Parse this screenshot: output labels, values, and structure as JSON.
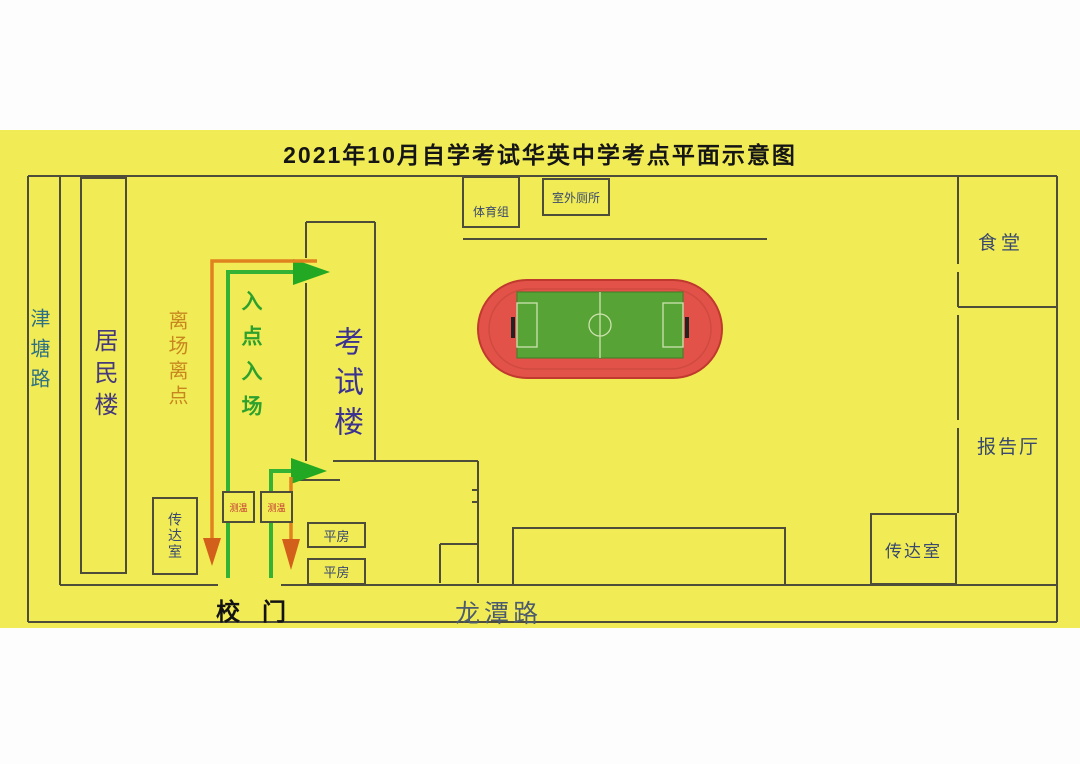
{
  "title": "2021年10月自学考试华英中学考点平面示意图",
  "roads": {
    "west": "津塘路",
    "south": "龙潭路"
  },
  "gate": {
    "label": "校门"
  },
  "buildings": {
    "residential": {
      "label": "居民楼"
    },
    "exam_building": {
      "label": "考试楼"
    },
    "sports_group": {
      "label": "体育组"
    },
    "outdoor_toilet": {
      "label": "室外厕所"
    },
    "canteen": {
      "label": "食堂"
    },
    "lecture_hall": {
      "label": "报告厅"
    },
    "gatehouse_left": {
      "label": "传达室"
    },
    "gatehouse_right": {
      "label": "传达室"
    },
    "bungalow_north": {
      "label": "平房"
    },
    "bungalow_south": {
      "label": "平房"
    },
    "temp_check_left": {
      "label": "测温"
    },
    "temp_check_right": {
      "label": "测温"
    }
  },
  "routes": {
    "entry": {
      "label": "入点入场",
      "color": "#2da02d"
    },
    "exit": {
      "label": "离场离点",
      "color": "#c8861e"
    }
  },
  "field": {
    "name": "running-track-with-soccer-pitch",
    "track_color": "#e25248",
    "pitch_color": "#57a336"
  },
  "colors": {
    "background": "#f1ec55",
    "wall": "#4d4d3a",
    "label_navy": "#39486e",
    "exam_label": "#3c3290",
    "road_west": "#2d7084",
    "road_south": "#4d5b6e",
    "title": "#151515"
  }
}
